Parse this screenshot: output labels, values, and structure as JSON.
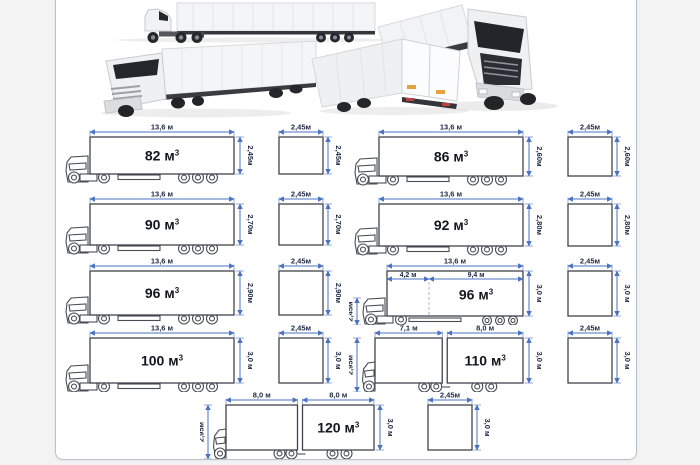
{
  "page": {
    "background_color": "#f3f3f4",
    "panel_background": "#ffffff",
    "panel_border_color": "#b7c3cc"
  },
  "colors": {
    "dimension_line": "#4a72c0",
    "dimension_text": "#1c2742",
    "volume_text": "#15161e",
    "drawing_line": "#4b4d56"
  },
  "photos": [
    {
      "name": "semi-truck-side-view-photo"
    },
    {
      "name": "semi-truck-front-three-quarter-photo"
    },
    {
      "name": "truck-cab-front-angle-photo"
    },
    {
      "name": "semi-truck-rear-three-quarter-photo"
    }
  ],
  "diagrams": [
    {
      "type": "semi",
      "volume_label": "82 м",
      "volume_sup": "3",
      "length_labels": [
        "13,6 м"
      ],
      "height_label": "2,45м",
      "section": {
        "width_label": "2,45м",
        "height_label": "2,45м"
      }
    },
    {
      "type": "semi",
      "volume_label": "86 м",
      "volume_sup": "3",
      "length_labels": [
        "13,6 м"
      ],
      "height_label": "2,60м",
      "section": {
        "width_label": "2,45м",
        "height_label": "2,60м"
      }
    },
    {
      "type": "semi",
      "volume_label": "90 м",
      "volume_sup": "3",
      "length_labels": [
        "13,6 м"
      ],
      "height_label": "2,70м",
      "section": {
        "width_label": "2,45м",
        "height_label": "2,70м"
      }
    },
    {
      "type": "semi",
      "volume_label": "92 м",
      "volume_sup": "3",
      "length_labels": [
        "13,6 м"
      ],
      "height_label": "2,80м",
      "section": {
        "width_label": "2,45м",
        "height_label": "2,80м"
      }
    },
    {
      "type": "semi",
      "volume_label": "96 м",
      "volume_sup": "3",
      "length_labels": [
        "13,6 м"
      ],
      "height_label": "2,90м",
      "section": {
        "width_label": "2,45м",
        "height_label": "2,90м"
      }
    },
    {
      "type": "split",
      "volume_label": "96 м",
      "volume_sup": "3",
      "length_labels": [
        "13,6 м"
      ],
      "segment_labels": [
        "4,2 м",
        "9,4 м"
      ],
      "cab_height_label": "2,45м",
      "height_label": "3,0 м",
      "section": {
        "width_label": "2,45м",
        "height_label": "3,0 м"
      }
    },
    {
      "type": "semi",
      "volume_label": "100 м",
      "volume_sup": "3",
      "length_labels": [
        "13,6 м"
      ],
      "height_label": "3,0 м",
      "section": {
        "width_label": "2,45м",
        "height_label": "3,0 м"
      }
    },
    {
      "type": "train",
      "volume_label": "110 м",
      "volume_sup": "3",
      "segment_labels": [
        "7,1 м",
        "8,0 м"
      ],
      "cab_height_label": "2,95м",
      "height_label": "3,0 м",
      "section": {
        "width_label": "2,45м",
        "height_label": "3,0 м"
      }
    },
    {
      "type": "train",
      "volume_label": "120 м",
      "volume_sup": "3",
      "segment_labels": [
        "8,0 м",
        "8,0 м"
      ],
      "cab_height_label": "2,95м",
      "height_label": "3,0 м",
      "section": {
        "width_label": "2,45м",
        "height_label": "3,0 м"
      }
    }
  ]
}
